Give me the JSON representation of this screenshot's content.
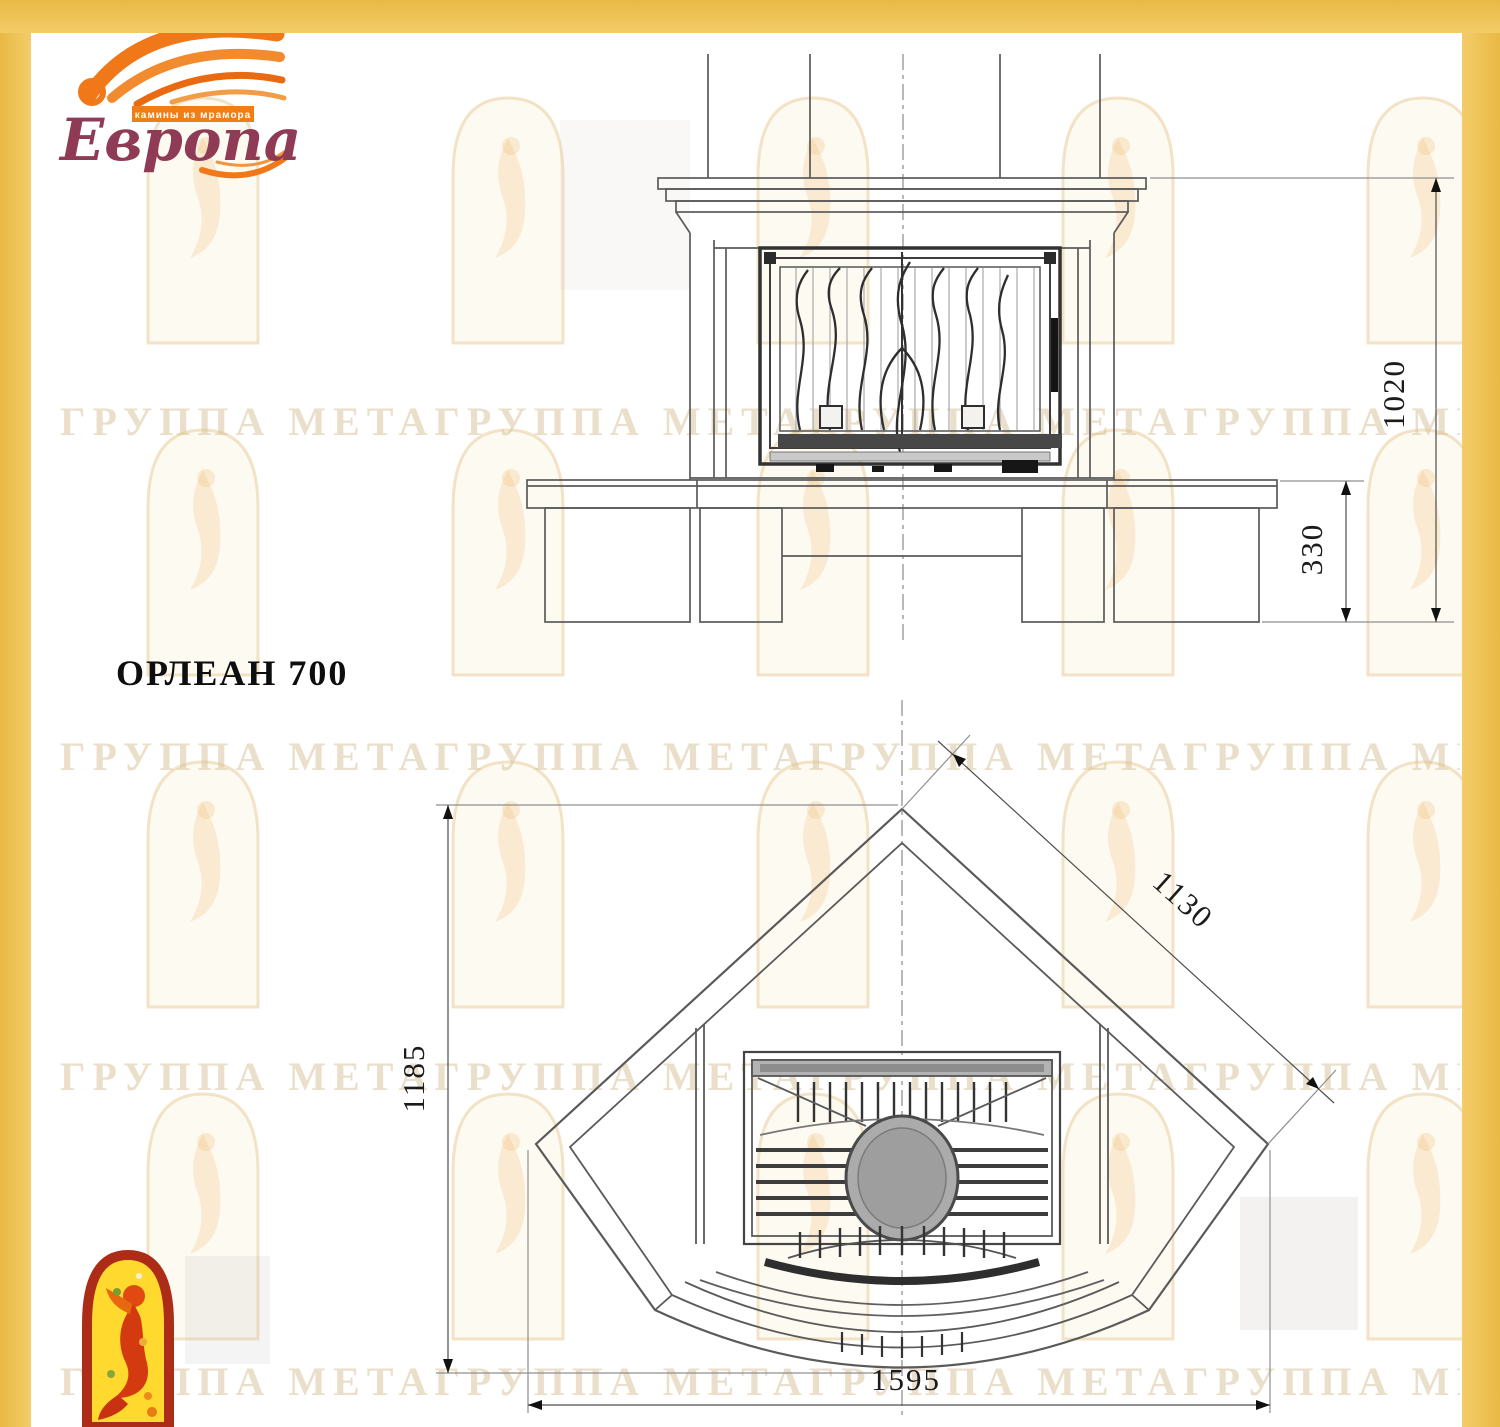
{
  "logo": {
    "brand": "Европа",
    "tagline": "камины из мрамора"
  },
  "title": {
    "model": "ОРЛЕАН 700"
  },
  "front_view": {
    "name": "front elevation of fireplace",
    "dims": {
      "total_height": "1020",
      "hearth_height": "330"
    }
  },
  "plan_view": {
    "name": "corner plan view of fireplace",
    "dims": {
      "depth": "1185",
      "side": "1130",
      "width": "1595"
    }
  },
  "watermark": {
    "band_text": "ГРУППА МЕТАГРУППА МЕТАГРУППА МЕТАГРУППА МЕТА"
  },
  "colors": {
    "frame_gold": "#F0C45C",
    "drawing_line": "#5A5A5A",
    "drawing_dark": "#1C1C1C",
    "logo_flame": "#F07818",
    "logo_text": "#8F3B55",
    "emblem_red": "#AD2C18",
    "emblem_yellow": "#FFD92E",
    "watermark_beige": "#D5BF96"
  }
}
